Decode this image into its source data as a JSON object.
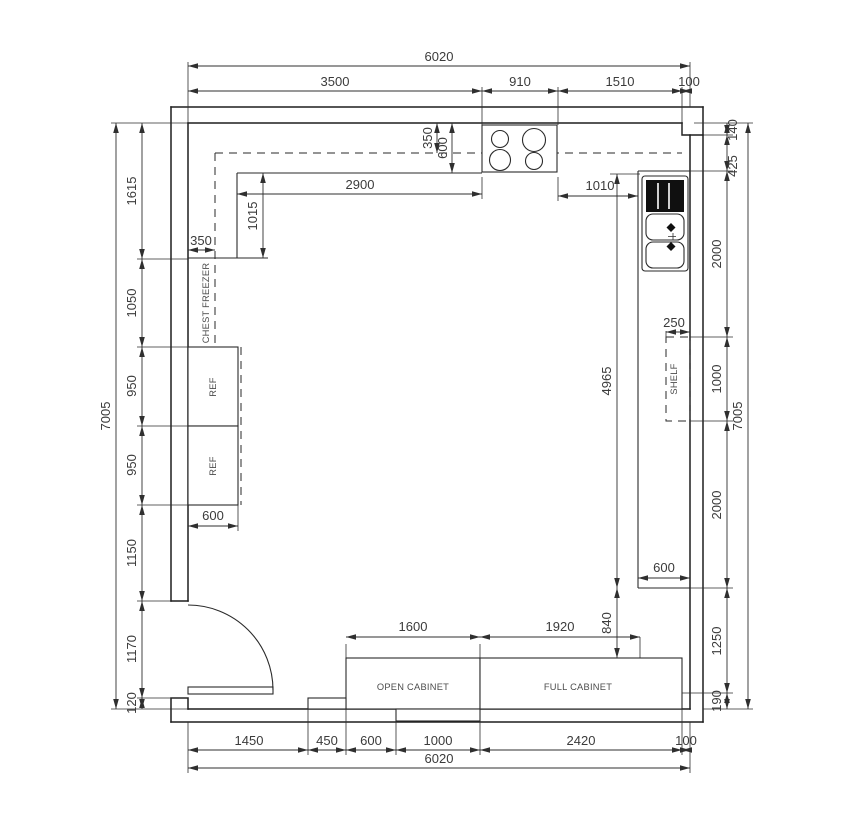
{
  "plan": {
    "colors": {
      "line": "#1f1f1f",
      "background": "#ffffff",
      "dim_text": "#3b3b3b"
    },
    "dims": {
      "top_total": "6020",
      "top": [
        "3500",
        "910",
        "1510",
        "100"
      ],
      "bottom": [
        "1450",
        "450",
        "600",
        "1000",
        "2420",
        "100"
      ],
      "bottom_total": "6020",
      "left": [
        "1615",
        "1050",
        "950",
        "950",
        "1150",
        "1170",
        "120"
      ],
      "left_total": "7005",
      "right": [
        "140",
        "425",
        "2000",
        "1000",
        "2000",
        "1250",
        "190"
      ],
      "right_total": "7005",
      "counter_top": "2900",
      "wall_gap": "1015",
      "upper_cabinet_depth": "350",
      "counter_depth": "600",
      "freezer_depth": "350",
      "ref_depth": "600",
      "stove_to_sink": "1010",
      "right_run": "4965",
      "cabinet_gap": "840",
      "right_counter_depth": "600",
      "shelf_depth": "250",
      "open_cabinet_width": "1600",
      "full_cabinet_width": "1920"
    },
    "fixtures": {
      "chest_freezer": "CHEST FREEZER",
      "ref_upper": "REF",
      "ref_lower": "REF",
      "shelf": "SHELF",
      "open_cabinet": "OPEN CABINET",
      "full_cabinet": "FULL CABINET"
    }
  }
}
